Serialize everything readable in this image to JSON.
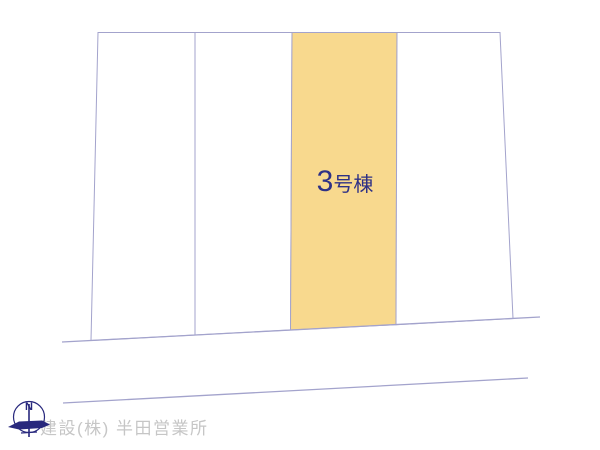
{
  "colors": {
    "highlight-fill": "#f8d98e",
    "boundary-line": "#a3a3cc",
    "label-text": "#2e3186",
    "watermark-text": "#c6c6c6",
    "compass-color": "#28287d"
  },
  "site_plan": {
    "plot_count": 4,
    "highlighted_plot": {
      "label": "3号棟",
      "label_number": "3",
      "label_suffix": "号棟"
    }
  },
  "compass": {
    "label": "N"
  },
  "watermark": {
    "text": "建設(株) 半田営業所"
  }
}
